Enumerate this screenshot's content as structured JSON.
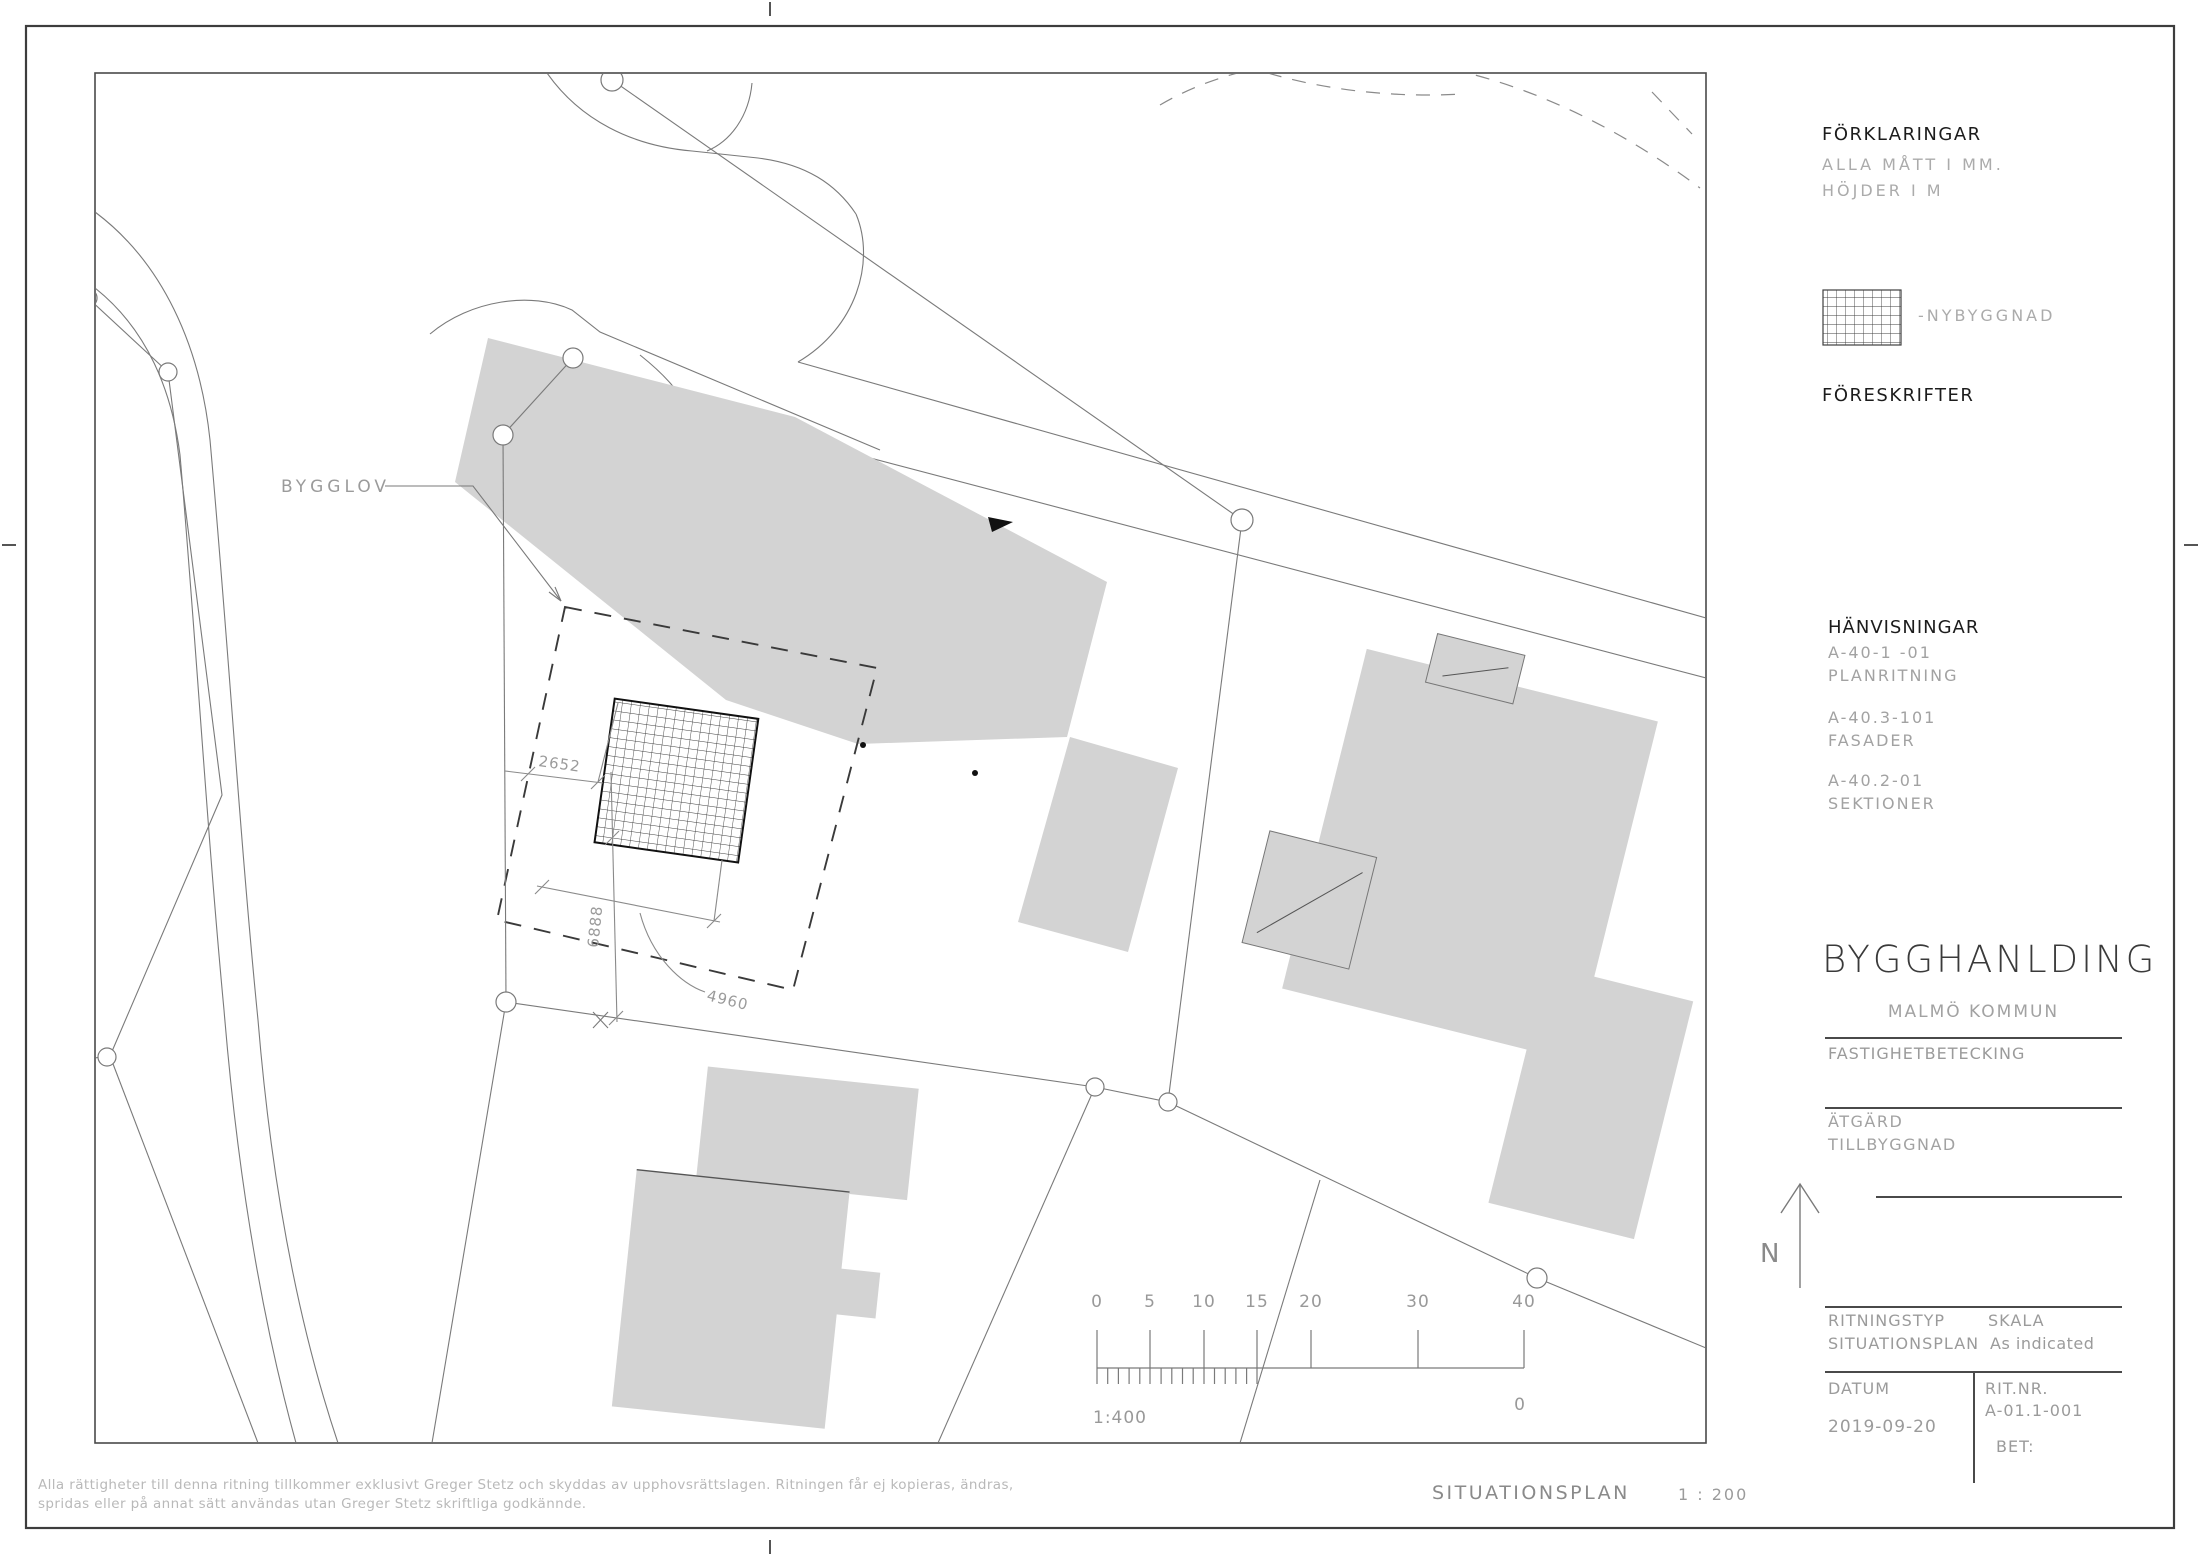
{
  "sidebar": {
    "forklaringar": {
      "title": "FÖRKLARINGAR",
      "line1": "ALLA MÅTT I MM.",
      "line2": "HÖJDER I M",
      "legend_label": "-NYBYGGNAD"
    },
    "foreskrifter_title": "FÖRESKRIFTER",
    "hanvisningar": {
      "title": "HÄNVISNINGAR",
      "refs": [
        {
          "code": "A-40-1  -01",
          "label": "PLANRITNING"
        },
        {
          "code": "A-40.3-101",
          "label": "FASADER"
        },
        {
          "code": "A-40.2-01",
          "label": "SEKTIONER"
        }
      ]
    },
    "titleblock": {
      "project": "BYGGHANLDING",
      "municipality": "MALMÖ KOMMUN",
      "fastighet_label": "FASTIGHETBETECKING",
      "atgard_label": "ÄTGÄRD",
      "atgard_value": "TILLBYGGNAD",
      "north_label": "N",
      "ritningstyp_label": "RITNINGSTYP",
      "ritningstyp_value": "SITUATIONSPLAN",
      "skala_label": "SKALA",
      "skala_value": "As indicated",
      "datum_label": "DATUM",
      "datum_value": "2019-09-20",
      "ritnr_label": "RIT.NR.",
      "ritnr_value": "A-01.1-001",
      "bet_label": "BET:"
    }
  },
  "plan": {
    "bygglov_label": "BYGGLOV",
    "dim_width": "2652",
    "dim_height": "6888",
    "dim_diag": "4960",
    "scalebar": {
      "ticks": [
        "0",
        "5",
        "10",
        "15",
        "20",
        "30",
        "40"
      ],
      "scale_label": "1:400",
      "right_label": "0"
    }
  },
  "footer": {
    "copyright_line1": "Alla rättigheter till denna ritning tillkommer exklusivt Greger Stetz och skyddas av upphovsrättslagen. Ritningen får ej kopieras, ändras,",
    "copyright_line2": "spridas eller på annat sätt användas utan Greger Stetz skriftliga godkännde.",
    "view_title": "SITUATIONSPLAN",
    "view_scale": "1 : 200"
  }
}
